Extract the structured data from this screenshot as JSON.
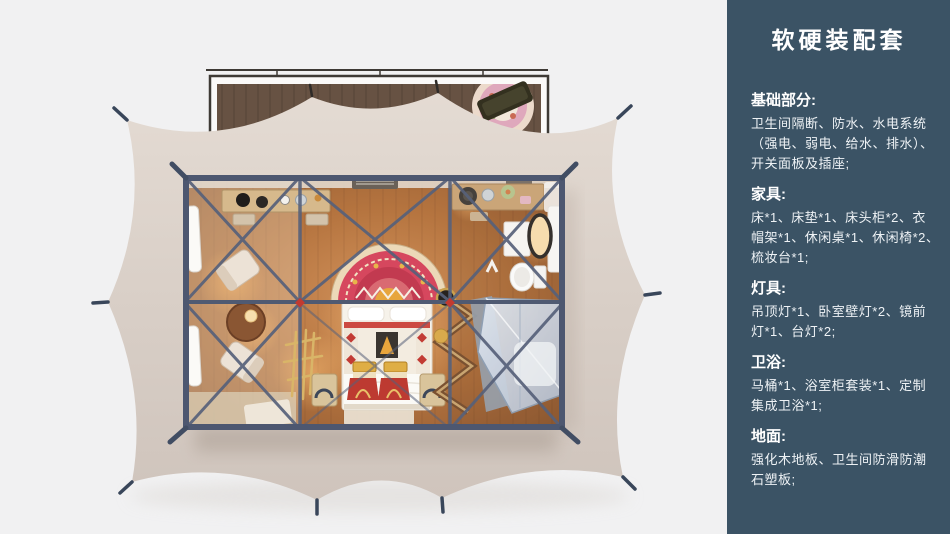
{
  "sidebar": {
    "bg_color": "#3b5365",
    "title": "软硬装配套",
    "sections": [
      {
        "heading": "基础部分:",
        "body": "卫生间隔断、防水、水电系统\n（强电、弱电、给水、排水）、\n开关面板及插座;"
      },
      {
        "heading": "家具:",
        "body": "床*1、床垫*1、床头柜*2、衣\n帽架*1、休闲桌*1、休闲椅*2、\n梳妆台*1;"
      },
      {
        "heading": "灯具:",
        "body": "吊顶灯*1、卧室壁灯*2、镜前\n灯*1、台灯*2;"
      },
      {
        "heading": "卫浴:",
        "body": "马桶*1、浴室柜套装*1、定制\n集成卫浴*1;"
      },
      {
        "heading": "地面:",
        "body": "强化木地板、卫生间防滑防潮\n石塑板;"
      }
    ]
  },
  "floorplan": {
    "scene": "tent-room-top-view-render",
    "colors": {
      "background": "#f1f1f2",
      "canopy": "#d9cfc7",
      "steel_frame": "#4d5770",
      "wood_floor": "#b5743f",
      "deck_wood": "#675243",
      "shower_glass": "#c6d1e0",
      "connector_node": "#c23a30",
      "headboard_rug": "#d6475e"
    },
    "elements": [
      "deck",
      "deck-rug",
      "deck-bench",
      "tent-canopy",
      "tent-stakes",
      "room-frame",
      "vanity-desk",
      "lounge-chairs",
      "side-table",
      "bed",
      "headboard-rug",
      "dowry-chests",
      "nightstands",
      "coat-rack",
      "clothes-rack",
      "washstand",
      "mirror",
      "toilet",
      "shower",
      "floor-mats"
    ]
  }
}
